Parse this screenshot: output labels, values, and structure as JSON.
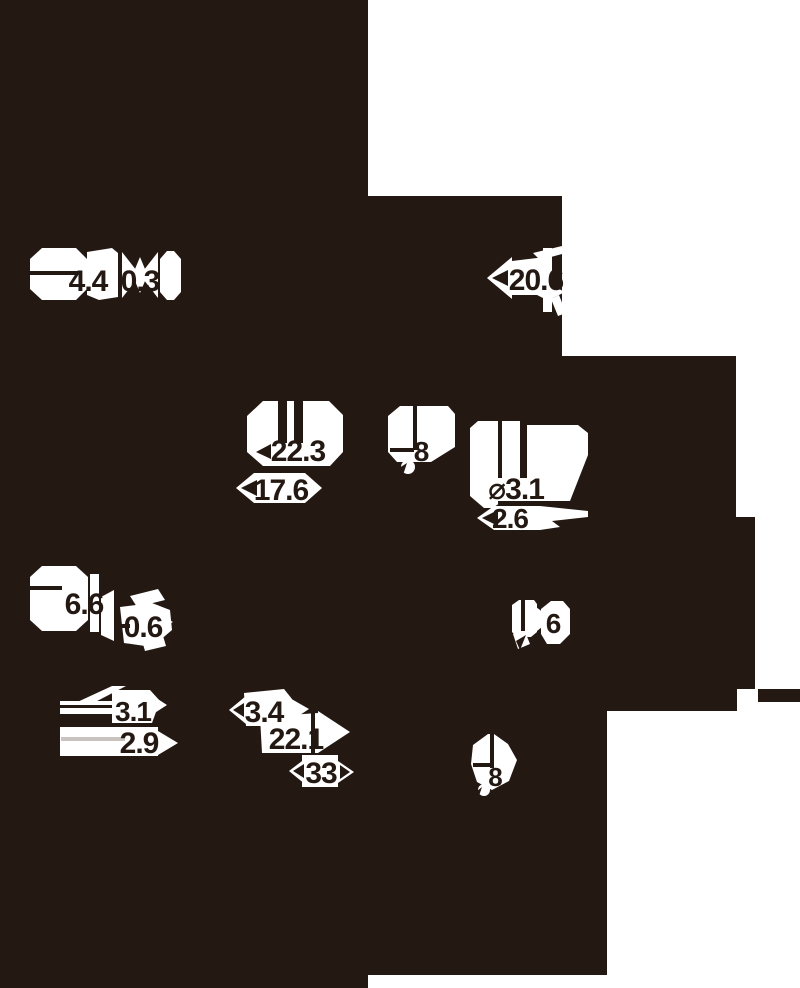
{
  "canvas": {
    "background": "#241813",
    "paper": "#ffffff",
    "muted_line": "#c9c2be"
  },
  "dimensions": [
    {
      "id": "dim-4-4",
      "label": "4.4"
    },
    {
      "id": "dim-0-3",
      "label": "0.3"
    },
    {
      "id": "dim-20-6",
      "label": "20.6"
    },
    {
      "id": "dim-22-3",
      "label": "22.3"
    },
    {
      "id": "dim-17-6",
      "label": "17.6"
    },
    {
      "id": "dim-8-top",
      "label": "8"
    },
    {
      "id": "dim-dia-3-1",
      "label": "⌀3.1"
    },
    {
      "id": "dim-2-6",
      "label": "2.6"
    },
    {
      "id": "dim-6-6",
      "label": "6.6"
    },
    {
      "id": "dim-0-6",
      "label": "0.6"
    },
    {
      "id": "dim-6",
      "label": "6"
    },
    {
      "id": "dim-3-1",
      "label": "3.1"
    },
    {
      "id": "dim-2-9",
      "label": "2.9"
    },
    {
      "id": "dim-3-4",
      "label": "3.4"
    },
    {
      "id": "dim-22-1",
      "label": "22.1"
    },
    {
      "id": "dim-33",
      "label": "33"
    },
    {
      "id": "dim-8-bottom",
      "label": "8"
    }
  ]
}
